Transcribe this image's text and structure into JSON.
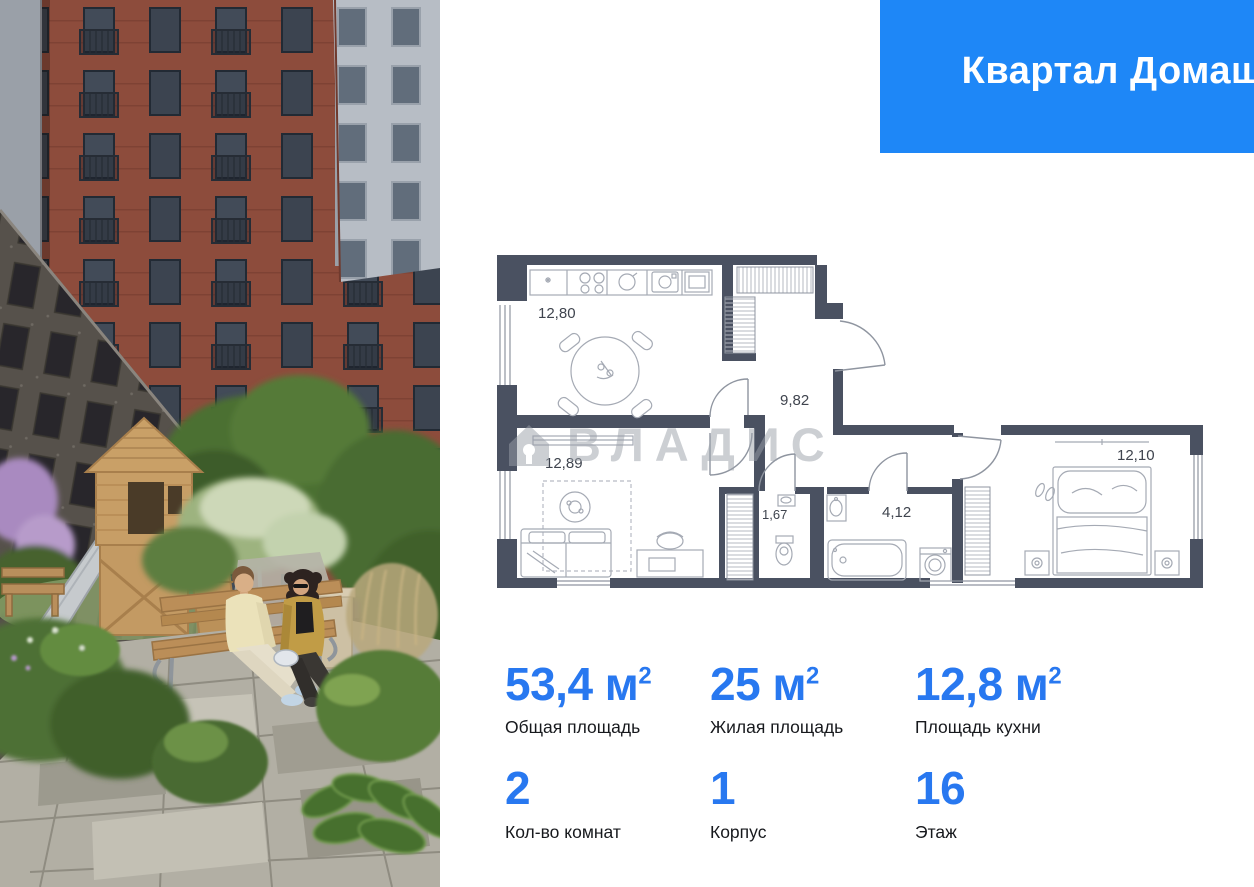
{
  "header": {
    "project_name": "Квартал Домашний",
    "brand_name": "самолет",
    "background_color": "#1e87f7"
  },
  "floor_plan": {
    "watermark_text": "ВЛАДИС",
    "wall_color": "#4a5161",
    "rooms": {
      "kitchen": "12,80",
      "hallway": "9,82",
      "living_room": "12,89",
      "wc": "1,67",
      "bathroom": "4,12",
      "bedroom": "12,10"
    }
  },
  "stats": {
    "accent_color": "#2878f0",
    "items": [
      {
        "value": "53,4",
        "unit": " м",
        "sup": "2",
        "label": "Общая площадь"
      },
      {
        "value": "25",
        "unit": " м",
        "sup": "2",
        "label": "Жилая площадь"
      },
      {
        "value": "12,8",
        "unit": " м",
        "sup": "2",
        "label": "Площадь кухни"
      },
      {
        "value": "2",
        "unit": "",
        "sup": "",
        "label": "Кол-во комнат"
      },
      {
        "value": "1",
        "unit": "",
        "sup": "",
        "label": "Корпус"
      },
      {
        "value": "16",
        "unit": "",
        "sup": "",
        "label": "Этаж"
      }
    ]
  }
}
